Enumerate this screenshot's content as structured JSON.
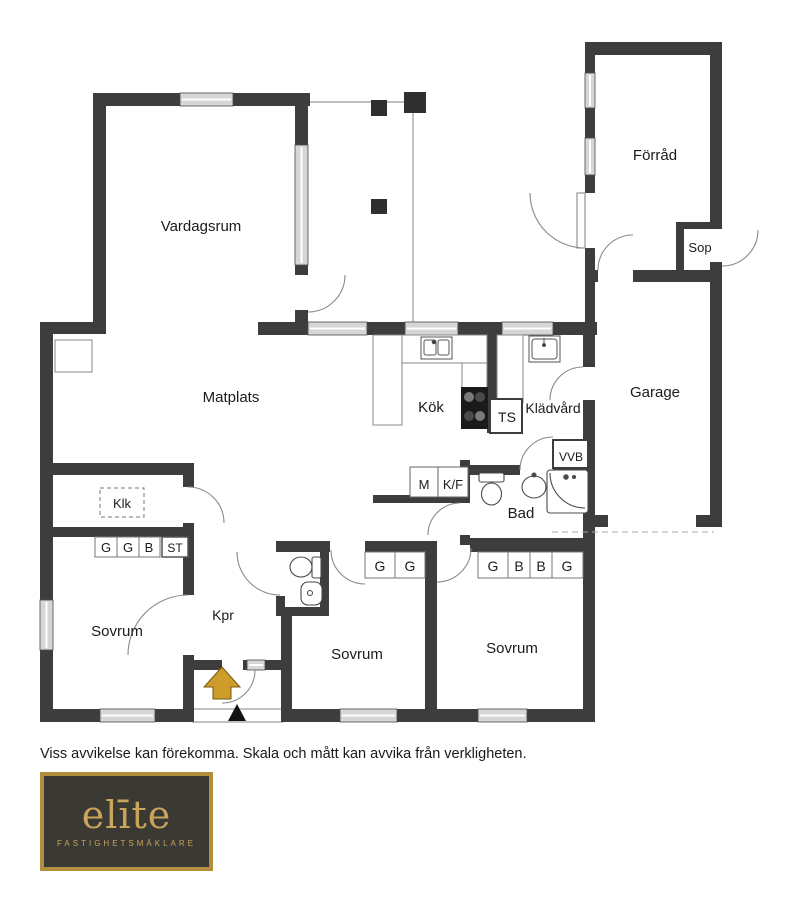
{
  "floorplan": {
    "labels": {
      "vardagsrum": "Vardagsrum",
      "matplats": "Matplats",
      "kok": "Kök",
      "ts": "TS",
      "kladvard": "Klädvård",
      "vvb": "VVB",
      "m": "M",
      "kf": "K/F",
      "bad": "Bad",
      "klk": "Klk",
      "st": "ST",
      "kpr": "Kpr",
      "sovrum1": "Sovrum",
      "sovrum2": "Sovrum",
      "sovrum3": "Sovrum",
      "forrad": "Förråd",
      "sop": "Sop",
      "garage": "Garage"
    },
    "closets": {
      "klk_row": [
        "G",
        "G",
        "B"
      ],
      "mid_row": [
        "G",
        "G"
      ],
      "right_row": [
        "G",
        "B",
        "B",
        "G"
      ]
    },
    "colors": {
      "wall": "#3d3d3d",
      "window": "#d6d6d6",
      "entrance_arrow": "#cd9c2a"
    }
  },
  "disclaimer": "Viss avvikelse kan förekomma. Skala och mått kan avvika från verkligheten.",
  "logo": {
    "brand": "elīte",
    "tagline": "FASTIGHETSMÄKLARE",
    "background": "#3a3933",
    "gold": "#c9a45b"
  }
}
